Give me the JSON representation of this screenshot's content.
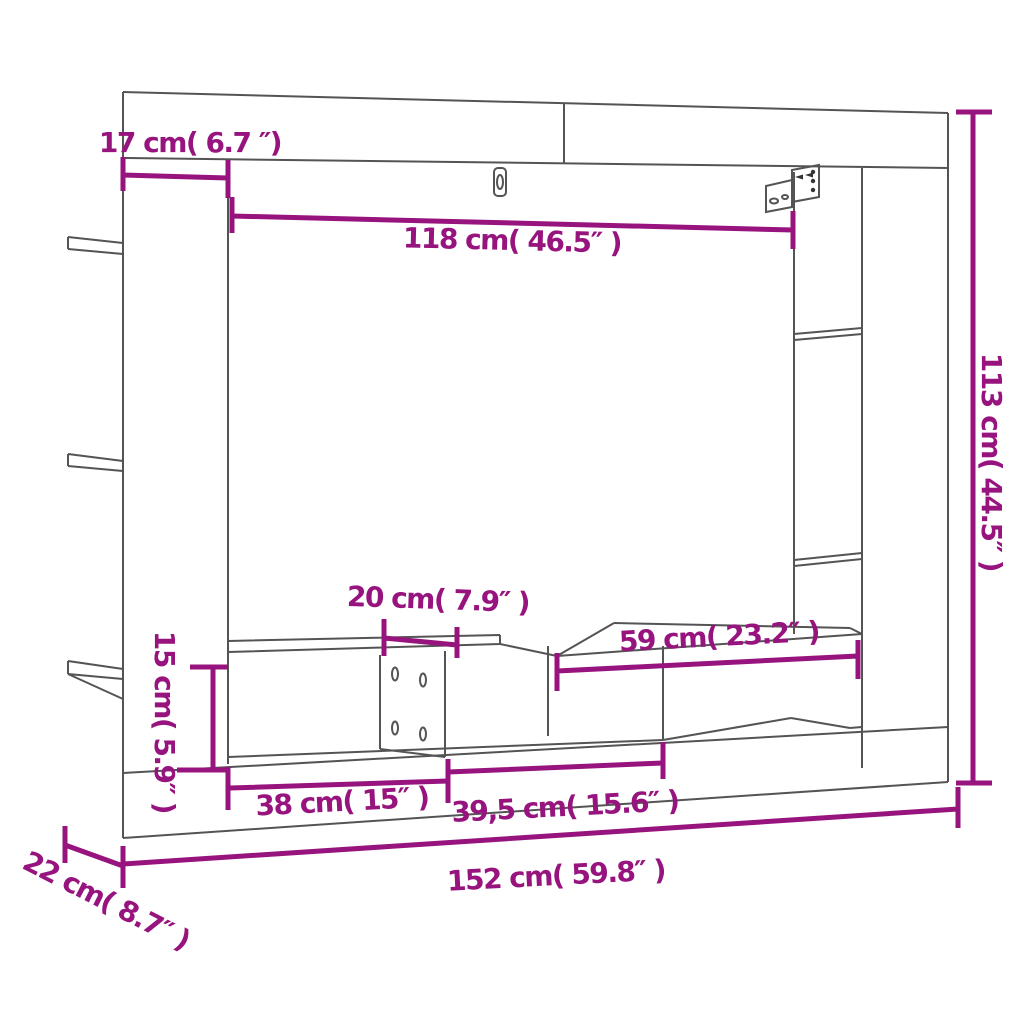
{
  "diagram": {
    "title": "TV wall unit dimension diagram",
    "accent_color": "#97137E",
    "line_color": "#545454",
    "background_color": "#ffffff",
    "labels": {
      "top_depth": "17 cm( 6.7 ″)",
      "inner_width": "118 cm( 46.5″ )",
      "total_height": "113 cm( 44.5″ )",
      "top_shelf_width": "20 cm( 7.9″ )",
      "right_compartment_width": "59 cm( 23.2″ )",
      "bench_height": "15 cm( 5.9″ )",
      "left_compartment_width": "38 cm( 15″ )",
      "middle_compartment_width": "39,5 cm( 15.6″ )",
      "total_width": "152 cm( 59.8″ )",
      "side_depth": "22 cm( 8.7″ )"
    }
  }
}
